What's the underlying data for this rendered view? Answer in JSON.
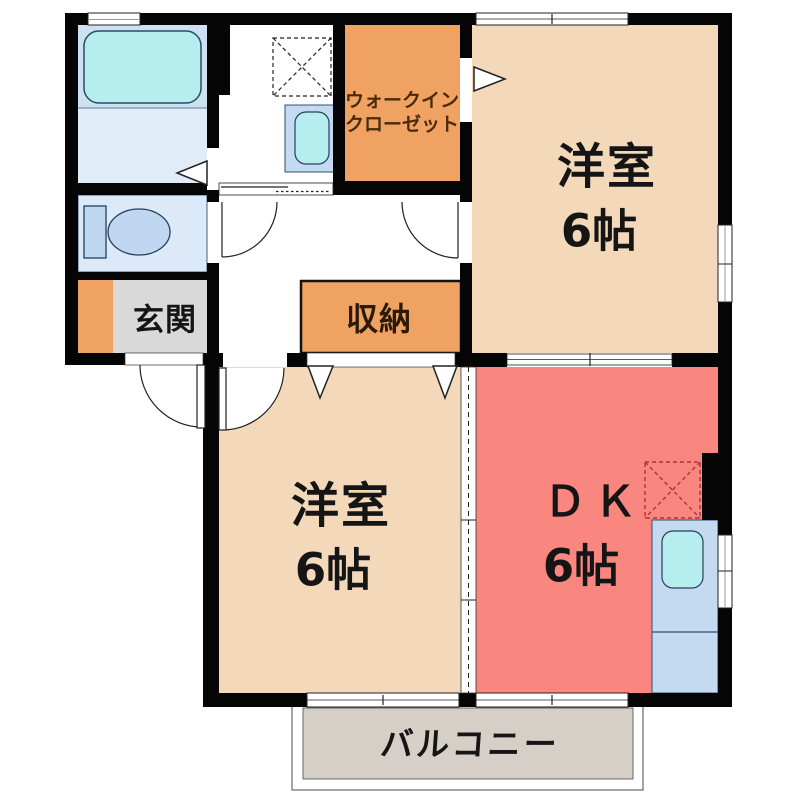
{
  "floorplan": {
    "type": "japanese-apartment-floor-plan",
    "layout_name": "2DK",
    "rooms": {
      "western_room_top": {
        "label": "洋室",
        "size": "6帖"
      },
      "western_room_bottom": {
        "label": "洋室",
        "size": "6帖"
      },
      "dining_kitchen": {
        "label": "ＤＫ",
        "size": "6帖"
      },
      "walk_in_closet": {
        "label_line1": "ウォークイン",
        "label_line2": "クローゼット"
      },
      "storage": {
        "label": "収納"
      },
      "entrance": {
        "label": "玄関"
      },
      "balcony": {
        "label": "バルコニー"
      }
    },
    "fixtures": [
      "bathtub",
      "washbasin",
      "washing-machine-pan",
      "toilet",
      "kitchen-sink",
      "gas-stove"
    ],
    "colors": {
      "wall_black": "#050505",
      "room_peach": "#f4d8ba",
      "dk_red": "#f9867f",
      "closet_orange": "#f0a263",
      "bath_blue": "#cde1f3",
      "washroom_blue": "#e0edf9",
      "toilet_blue": "#dce9f8",
      "fixture_blue": "#c3daf1",
      "water_cyan": "#b6eef0",
      "entrance_gray": "#d9d9d9",
      "balcony_gray": "#d6cfc7",
      "stove_dash_red": "#b03434",
      "closet_text_brown": "#4a2a08"
    }
  }
}
